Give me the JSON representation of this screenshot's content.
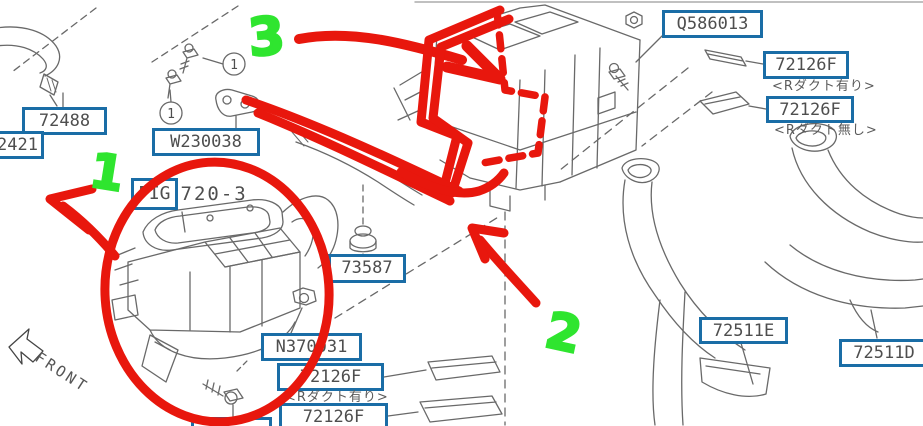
{
  "colors": {
    "box_blue": "#1a6da6",
    "annotation_red": "#e8170d",
    "annotation_green": "#2fe52f",
    "line_gray": "#696969",
    "text_gray": "#4e4e4e"
  },
  "front_label": "FRONT",
  "callouts": {
    "circled_number": "1"
  },
  "annotations": {
    "one": "1",
    "two": "2",
    "three": "3"
  },
  "labels": {
    "q586013": "Q586013",
    "top_72126f_a": "72126F",
    "top_72126f_a_note": "<Rダクト有り>",
    "top_72126f_b": "72126F",
    "top_72126f_b_note": "<Rダクト無し>",
    "p72488": "72488",
    "p72421_partial": "2421",
    "w230038": "W230038",
    "fig_boxed": "FIG",
    "fig_rest": "720-3",
    "p73587": "73587",
    "n370031": "N370031",
    "bottom_72126f_a": "72126F",
    "bottom_72126f_a_note": "<Rダクト有り>",
    "bottom_72126f_b": "72126F",
    "bottom_partial": "",
    "p72511e": "72511E",
    "p72511d": "72511D"
  }
}
